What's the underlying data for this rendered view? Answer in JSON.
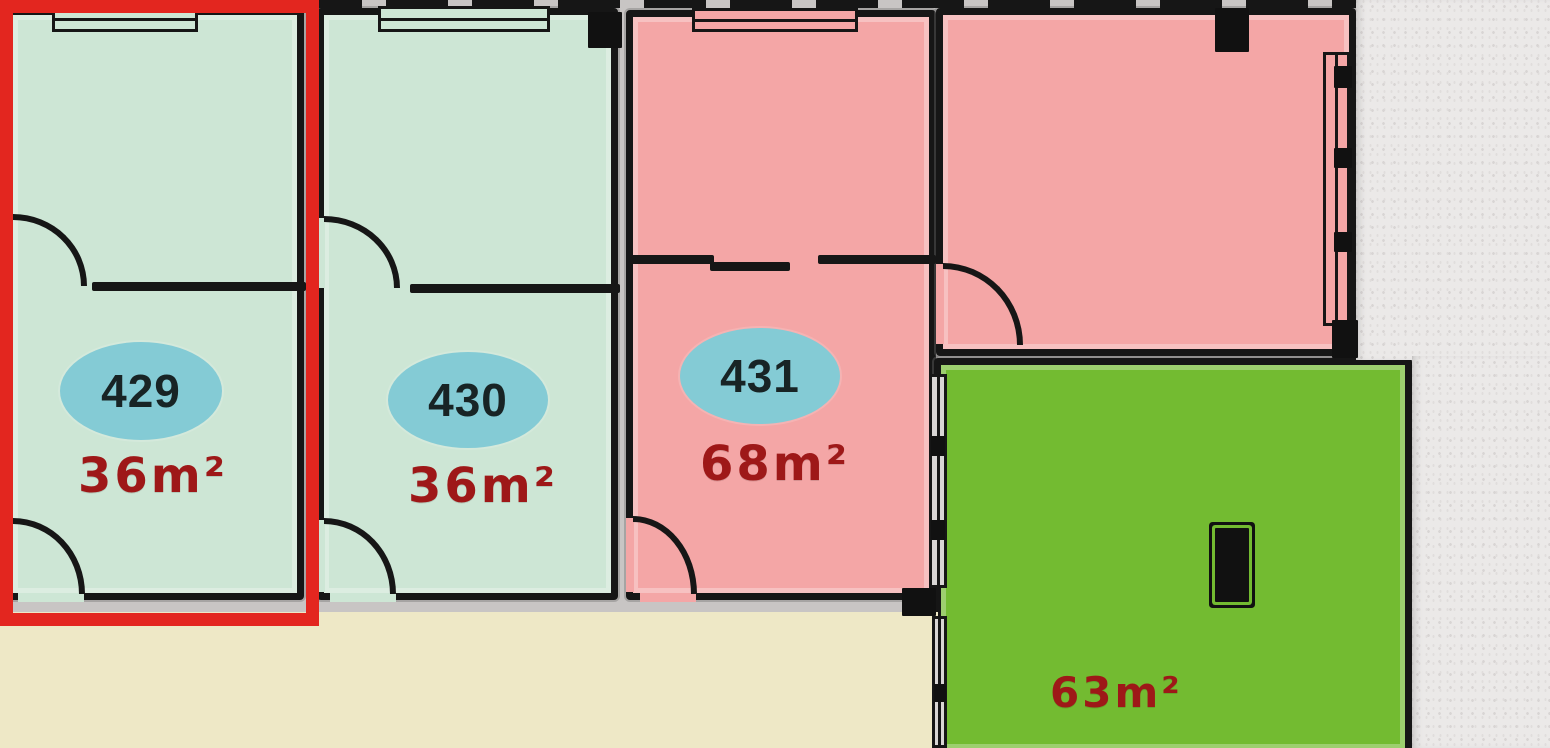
{
  "plan": {
    "title": "apartment floor plan – 4th floor units",
    "units": [
      {
        "number": "429",
        "area": "36m²",
        "room_color": "#cde6d5",
        "badge_color": "#84cbd5",
        "selected": true
      },
      {
        "number": "430",
        "area": "36m²",
        "room_color": "#cde6d5",
        "badge_color": "#84cbd5",
        "selected": false
      },
      {
        "number": "431",
        "area": "68m²",
        "room_color": "#f4a6a6",
        "badge_color": "#84cbd5",
        "selected": false
      },
      {
        "number": "",
        "area": "63m²",
        "room_color": "#73bb31",
        "badge_color": "",
        "selected": false
      }
    ],
    "colors": {
      "wall": "#161616",
      "plan_background": "#c8c5c4",
      "corridor": "#eee8c6",
      "outside": "#ebe9e8",
      "selection_highlight": "#e3261f",
      "area_label_text": "#9e1818",
      "unit_number_text": "#182425"
    }
  }
}
